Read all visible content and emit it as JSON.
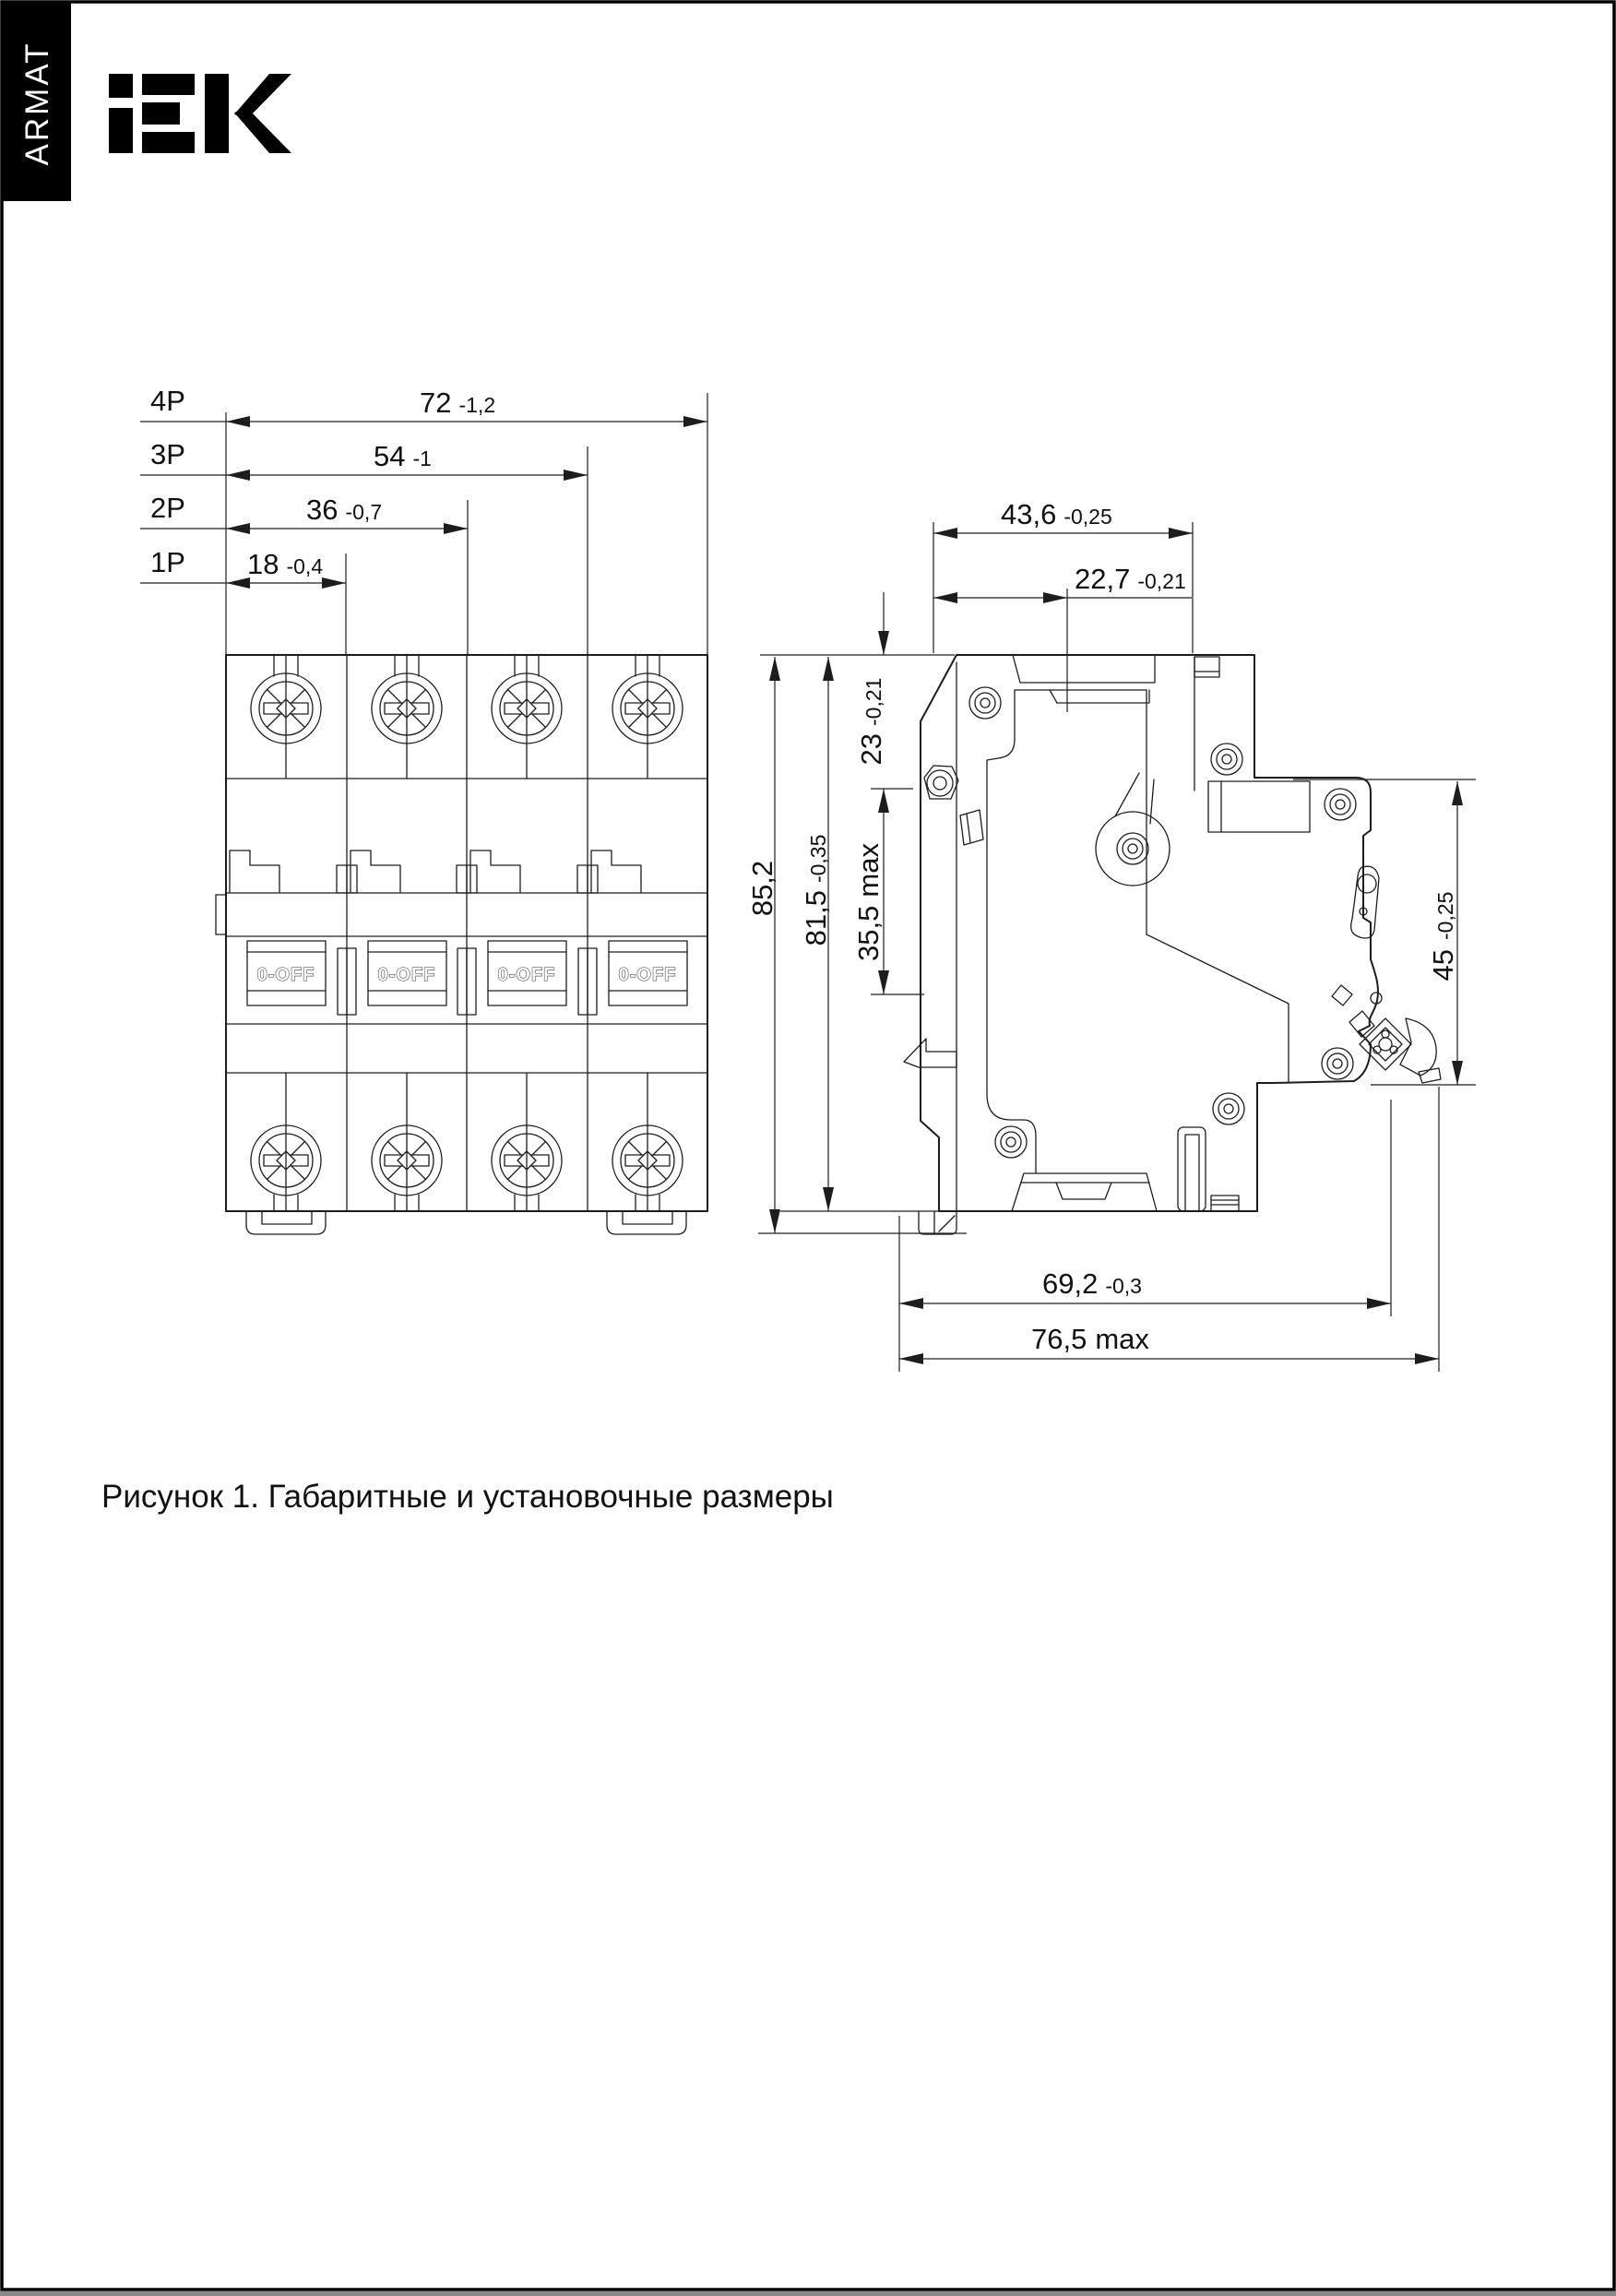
{
  "page": {
    "brand_tab": "ARMAT",
    "logo_text": "IEK",
    "caption": "Рисунок 1. Габаритные и установочные размеры"
  },
  "front_view": {
    "handle_text": "0-OFF",
    "dims": [
      {
        "pole": "4P",
        "value": "72",
        "tol": "-1,2"
      },
      {
        "pole": "3P",
        "value": "54",
        "tol": "-1"
      },
      {
        "pole": "2P",
        "value": "36",
        "tol": "-0,7"
      },
      {
        "pole": "1P",
        "value": "18",
        "tol": "-0,4"
      }
    ]
  },
  "side_view": {
    "dims": {
      "depth_total": {
        "value": "43,6",
        "tol": "-0,25",
        "suffix": ""
      },
      "depth_step": {
        "value": "22,7",
        "tol": "-0,21",
        "suffix": ""
      },
      "height_overall": {
        "value": "85,2",
        "tol": "",
        "suffix": ""
      },
      "height_body": {
        "value": "81,5",
        "tol": "-0,35",
        "suffix": ""
      },
      "top_to_rail": {
        "value": "23",
        "tol": "-0,21",
        "suffix": ""
      },
      "rail_zone": {
        "value": "35,5",
        "tol": "",
        "suffix": "max"
      },
      "front_height": {
        "value": "45",
        "tol": "-0,25",
        "suffix": ""
      },
      "mount_depth": {
        "value": "69,2",
        "tol": "-0,3",
        "suffix": ""
      },
      "max_depth": {
        "value": "76,5",
        "tol": "",
        "suffix": "max"
      }
    }
  }
}
